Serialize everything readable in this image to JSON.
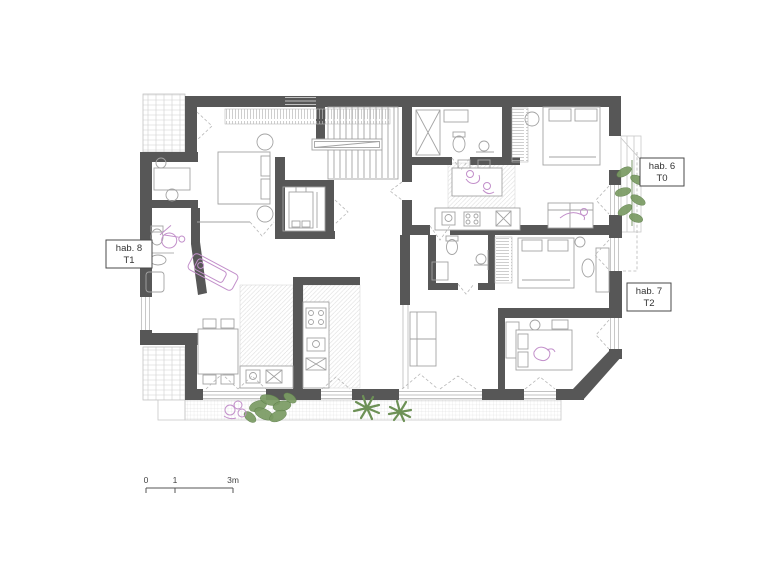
{
  "drawing": {
    "kind": "architectural floor plan",
    "background": "#ffffff"
  },
  "unit_labels": {
    "unit6": {
      "name": "hab. 6",
      "type": "T0"
    },
    "unit7": {
      "name": "hab. 7",
      "type": "T2"
    },
    "unit8": {
      "name": "hab. 8",
      "type": "T1"
    }
  },
  "scale_bar": {
    "start": "0",
    "mid": "1",
    "end": "3m"
  },
  "colors": {
    "wall": "#575757",
    "furniture_line": "#a3a3a3",
    "accent_pink": "#c28fca",
    "plant_green": "#6f925a"
  },
  "symbols": {
    "stairs": "stairwell-treads",
    "elevator": "elevator-car",
    "plants": "potted-plants",
    "wheelchair": "accessible-bathroom-wheelchair"
  }
}
